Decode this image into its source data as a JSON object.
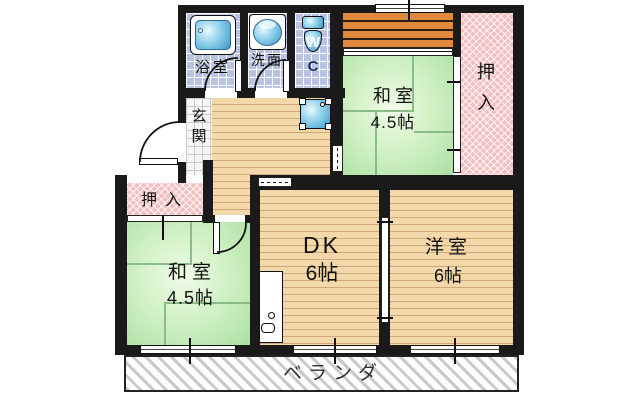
{
  "plan": {
    "type": "japanese-apartment-floor-plan",
    "rooms": {
      "bathroom": {
        "label": "浴室"
      },
      "washroom": {
        "label": "洗面"
      },
      "toilet": {
        "label_w": "W",
        "label_c": "C"
      },
      "entrance": {
        "label": "玄\n関"
      },
      "closet_left": {
        "label": "押入"
      },
      "closet_right": {
        "label": "押\n入"
      },
      "japanese_room_top": {
        "label": "和室",
        "size": "4.5帖"
      },
      "japanese_room_bottom": {
        "label": "和室",
        "size": "4.5帖"
      },
      "dining_kitchen": {
        "label": "DK",
        "size": "6帖"
      },
      "western_room": {
        "label": "洋室",
        "size": "6帖"
      },
      "veranda": {
        "label": "ベランダ"
      }
    },
    "colors": {
      "wall": "#1a1a1a",
      "tatami_green": "#abe0a2",
      "wood_floor": "#f3d9a9",
      "deck_orange": "#e0883c",
      "closet_pink": "#f3bfbf",
      "tile_blue": "#b9c3e6",
      "fixture_blue": "#3e97c9",
      "veranda_stripe": "#c9c9c9"
    },
    "fixtures": [
      "bathtub",
      "wash-basin",
      "toilet",
      "washing-machine-space",
      "kitchen-sink"
    ]
  }
}
